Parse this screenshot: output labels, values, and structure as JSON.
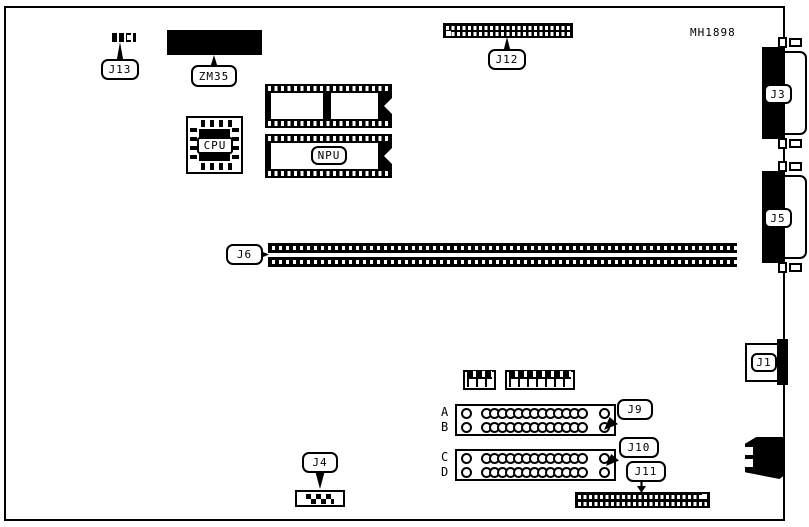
{
  "diagram": {
    "part_number": "MH1898",
    "callouts": {
      "j13": "J13",
      "zm35": "ZM35",
      "j12": "J12",
      "j6": "J6",
      "j9": "J9",
      "j10": "J10",
      "j11": "J11",
      "j4": "J4",
      "j3": "J3",
      "j5": "J5",
      "j1": "J1"
    },
    "chips": {
      "cpu": "CPU",
      "npu": "NPU"
    },
    "socket_rows": {
      "labels": [
        "A",
        "B",
        "C",
        "D"
      ],
      "mid_circle_count": 13
    },
    "colors": {
      "ink": "#000000",
      "background": "#ffffff"
    }
  }
}
